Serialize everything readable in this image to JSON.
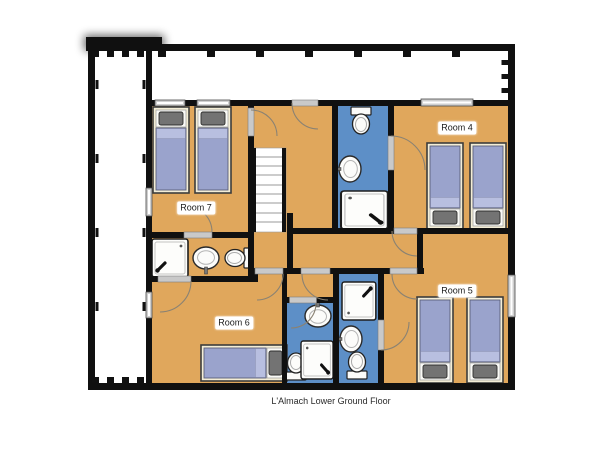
{
  "caption": "L'Almach Lower Ground Floor",
  "rooms": [
    {
      "label": "Room 4",
      "beds": 2
    },
    {
      "label": "Room 5",
      "beds": 2
    },
    {
      "label": "Room 6",
      "beds": 1
    },
    {
      "label": "Room 7",
      "beds": 2
    }
  ],
  "bathrooms": [
    {
      "name": "shower-room-centre-top",
      "fixtures": [
        "toilet",
        "sink",
        "shower"
      ]
    },
    {
      "name": "shower-room-room7",
      "fixtures": [
        "shower",
        "sink",
        "toilet"
      ]
    },
    {
      "name": "shower-room-lower-left",
      "fixtures": [
        "sink",
        "toilet",
        "shower"
      ]
    },
    {
      "name": "shower-room-lower-right",
      "fixtures": [
        "shower",
        "sink",
        "toilet"
      ]
    }
  ],
  "features": [
    "staircase",
    "terrace"
  ],
  "colors": {
    "floor": "#e0a75c",
    "bathroom_floor": "#5d8fc7",
    "wall": "#101010",
    "mattress": "#9aa3cc",
    "mattress_fold": "#b8bfe0",
    "pillow": "#737373",
    "bed_frame": "#f3edd6",
    "terrace": "#ffffff",
    "door_arc": "#8a8273"
  }
}
